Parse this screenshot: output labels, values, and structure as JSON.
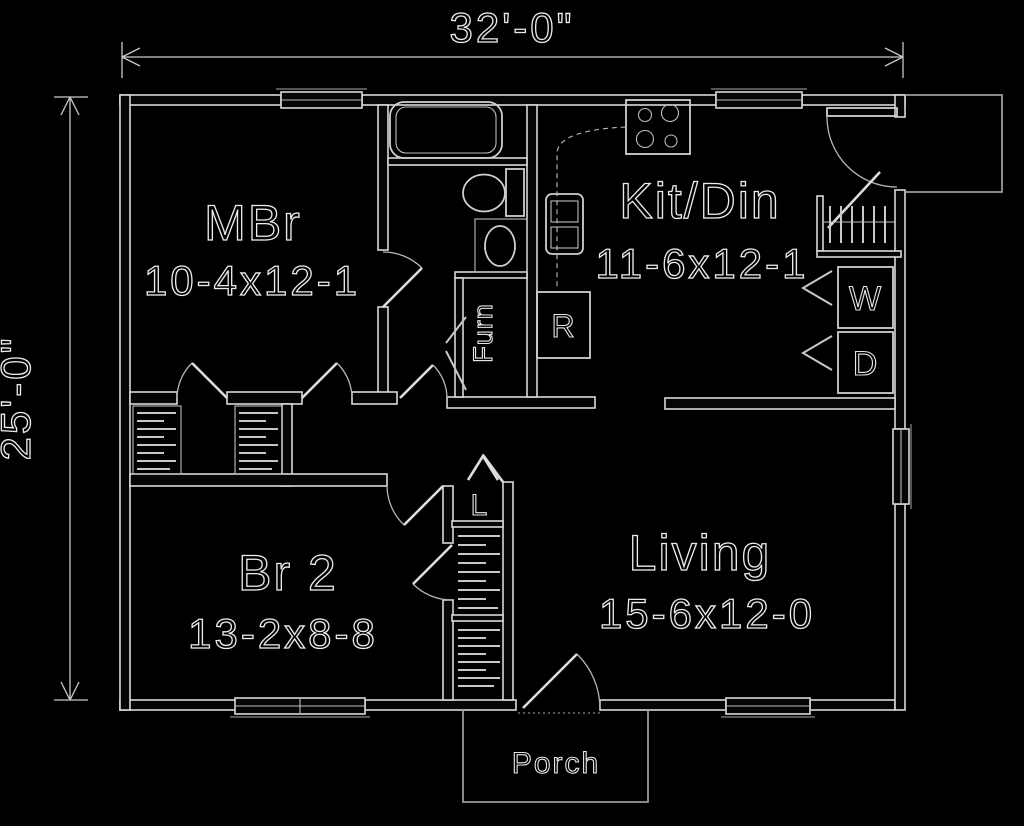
{
  "plan": {
    "overall": {
      "width_label": "32'-0\"",
      "height_label": "25'-0\""
    },
    "rooms": [
      {
        "name": "MBr",
        "dims": "10-4x12-1"
      },
      {
        "name": "Kit/Din",
        "dims": "11-6x12-1"
      },
      {
        "name": "Br 2",
        "dims": "13-2x8-8"
      },
      {
        "name": "Living",
        "dims": "15-6x12-0"
      },
      {
        "name": "Porch",
        "dims": ""
      }
    ],
    "fixtures": {
      "furnace": "Furn",
      "refrigerator": "R",
      "washer": "W",
      "dryer": "D",
      "linen": "L"
    },
    "colors": {
      "background": "#000000",
      "line": "#e6e6e6"
    }
  }
}
